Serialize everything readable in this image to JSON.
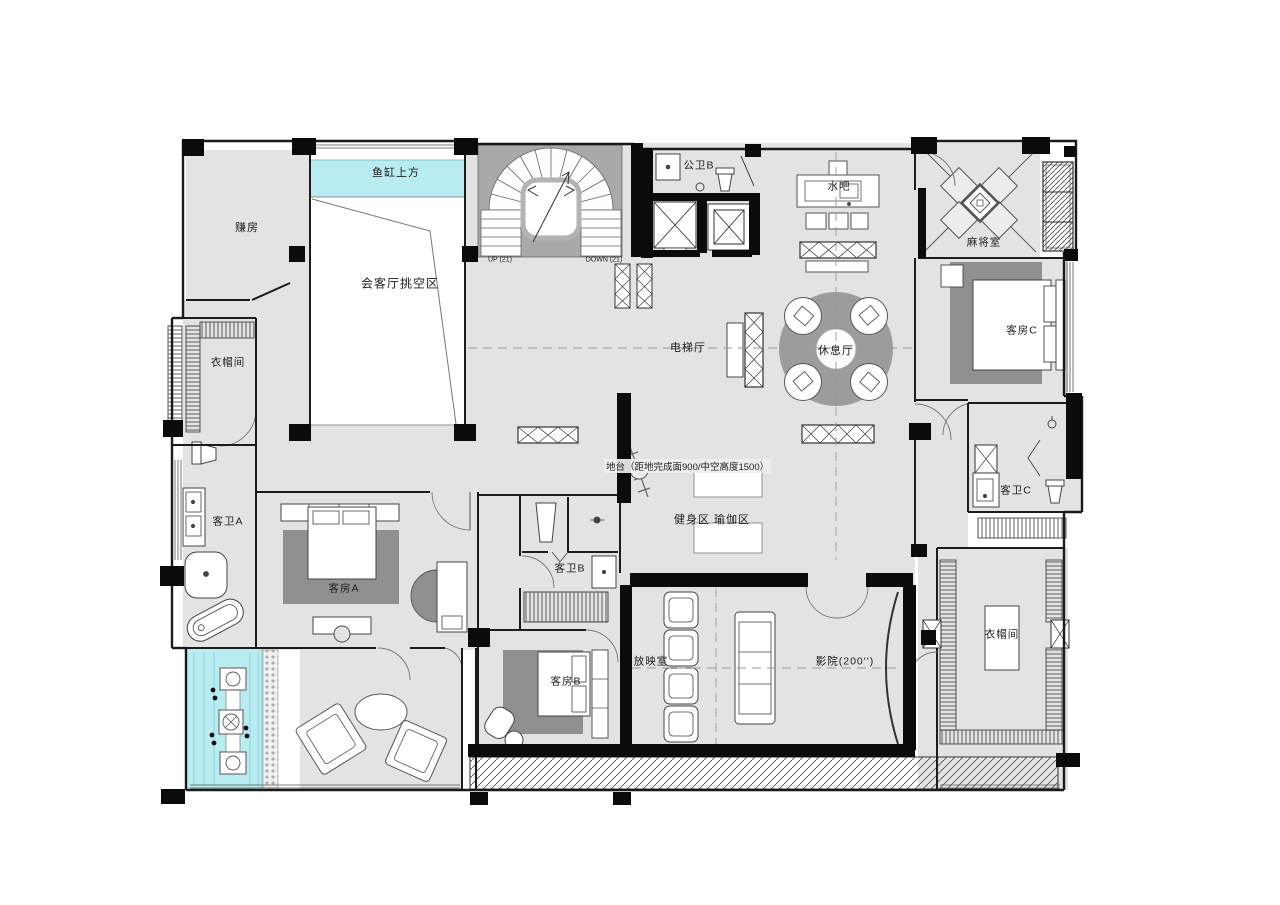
{
  "rooms": {
    "fish_tank": "鱼缸上方",
    "chamber": "赚房",
    "void_area": "会客厅挑空区",
    "cloakroom_left": "衣帽间",
    "stair_up": "UP (21)",
    "stair_down": "DOWN (21)",
    "public_bath_b": "公卫B",
    "water_bar": "水吧",
    "mahjong_room": "麻将室",
    "guest_room_c": "客房C",
    "elevator_hall": "电梯厅",
    "lounge": "休息厅",
    "guest_bath_c": "客卫C",
    "platform_note": "地台（距地完成面900/中空高度1500）",
    "gym": "健身区 瑜伽区",
    "guest_bath_a": "客卫A",
    "guest_room_a": "客房A",
    "guest_bath_b": "客卫B",
    "projection_room": "放映室",
    "guest_room_b": "客房B",
    "cinema": "影院(200'')",
    "cloakroom_right": "衣帽间"
  },
  "colors": {
    "floor": "#e3e3e4",
    "stair_floor": "#a9a9ab",
    "rug": "#8f9090",
    "lounge_circle": "#9b9c9c",
    "water": "#b9ecf1",
    "wall": "#0b0b0b"
  }
}
